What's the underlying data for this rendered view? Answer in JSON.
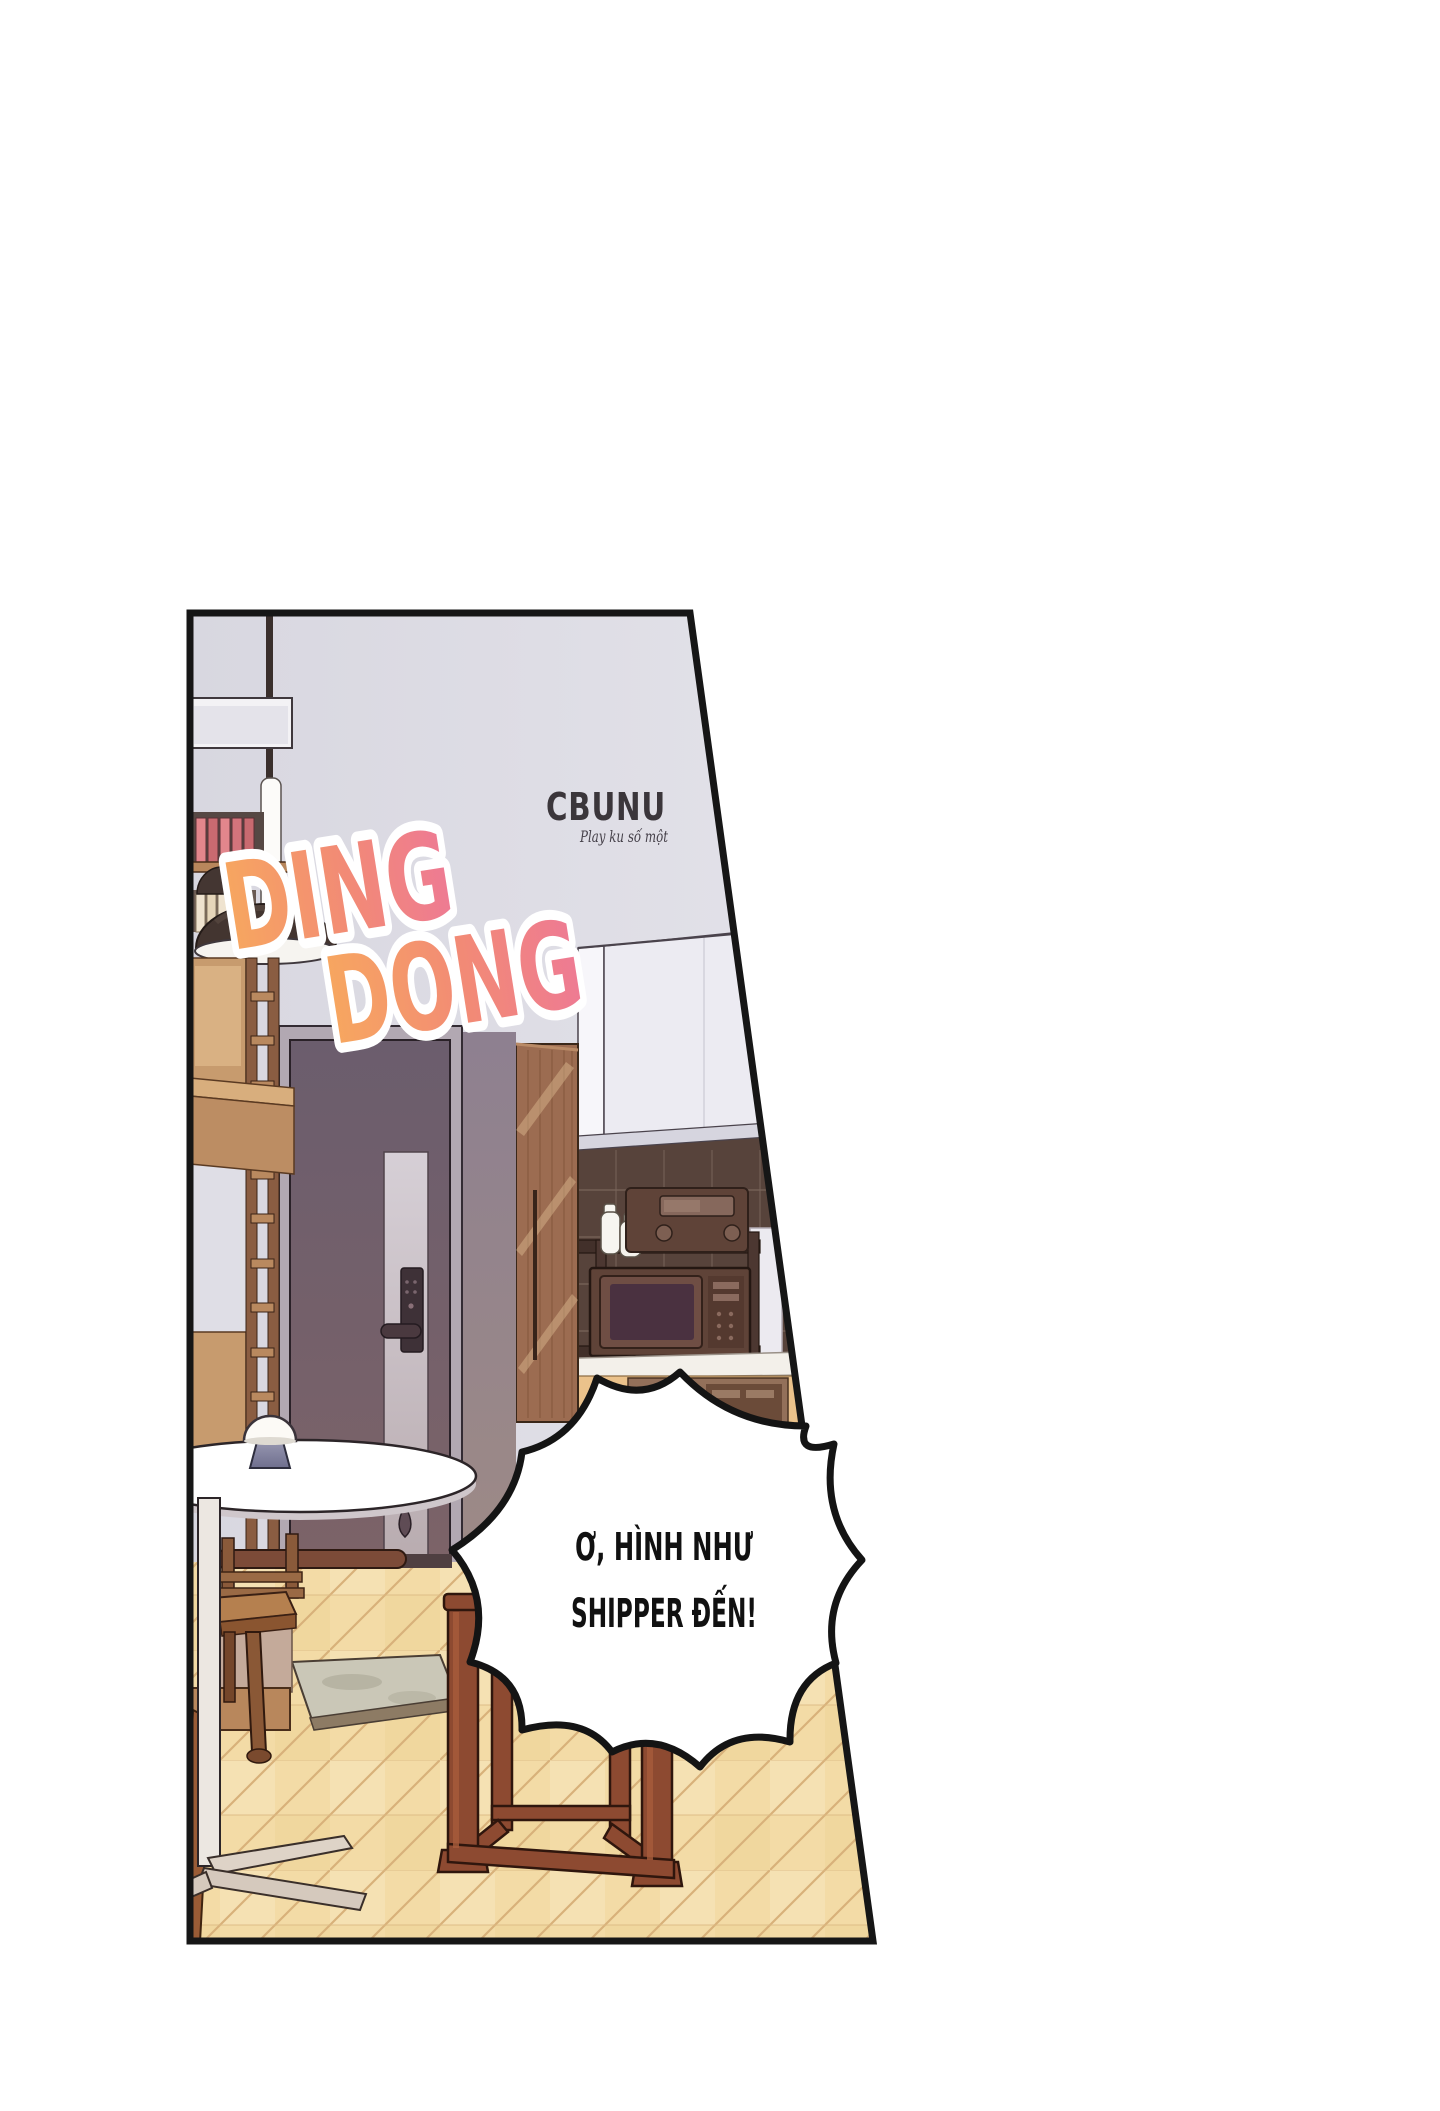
{
  "panel": {
    "sfx_word_1": "DING",
    "sfx_word_2": "DONG",
    "watermark_logo": "CBUNU",
    "watermark_tagline": "Play ku số một",
    "speech_line_1": "Ơ, HÌNH NHƯ",
    "speech_line_2": "SHIPPER ĐẾN!"
  },
  "colors": {
    "page_background": "#ffffff",
    "panel_border": "#161616",
    "wall": "#dcdbe4",
    "door": "#6e5e6d",
    "closet_wood": "#9c6c51",
    "backsplash_tile": "#57433b",
    "floor_parquet": "#f3dba6",
    "rug": "#cac7b7",
    "table": "#ffffff",
    "stool_wood": "#8d4a31",
    "sfx_gradient_start": "#f7a75f",
    "sfx_gradient_end": "#ee7a94",
    "speech_bubble_fill": "#ffffff",
    "speech_bubble_outline": "#141414",
    "speech_text": "#111111",
    "watermark_text": "#3b363b"
  }
}
